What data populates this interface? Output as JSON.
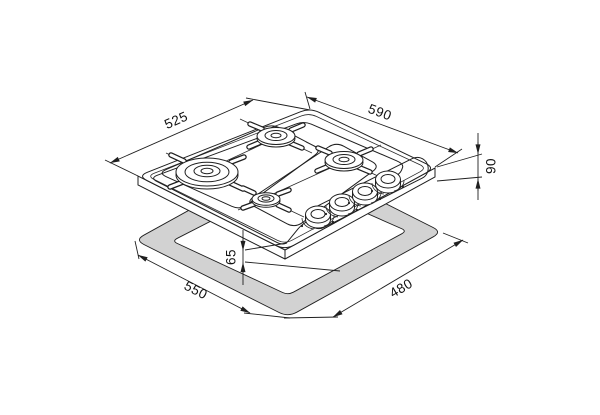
{
  "diagram": {
    "type": "installation-drawing",
    "product": "4-burner gas hob with worktop cutout",
    "dimensions_mm": {
      "hob_depth": "525",
      "hob_width": "590",
      "hob_height": "90",
      "base_recess_depth": "65",
      "cutout_width": "550",
      "cutout_depth": "480"
    }
  }
}
